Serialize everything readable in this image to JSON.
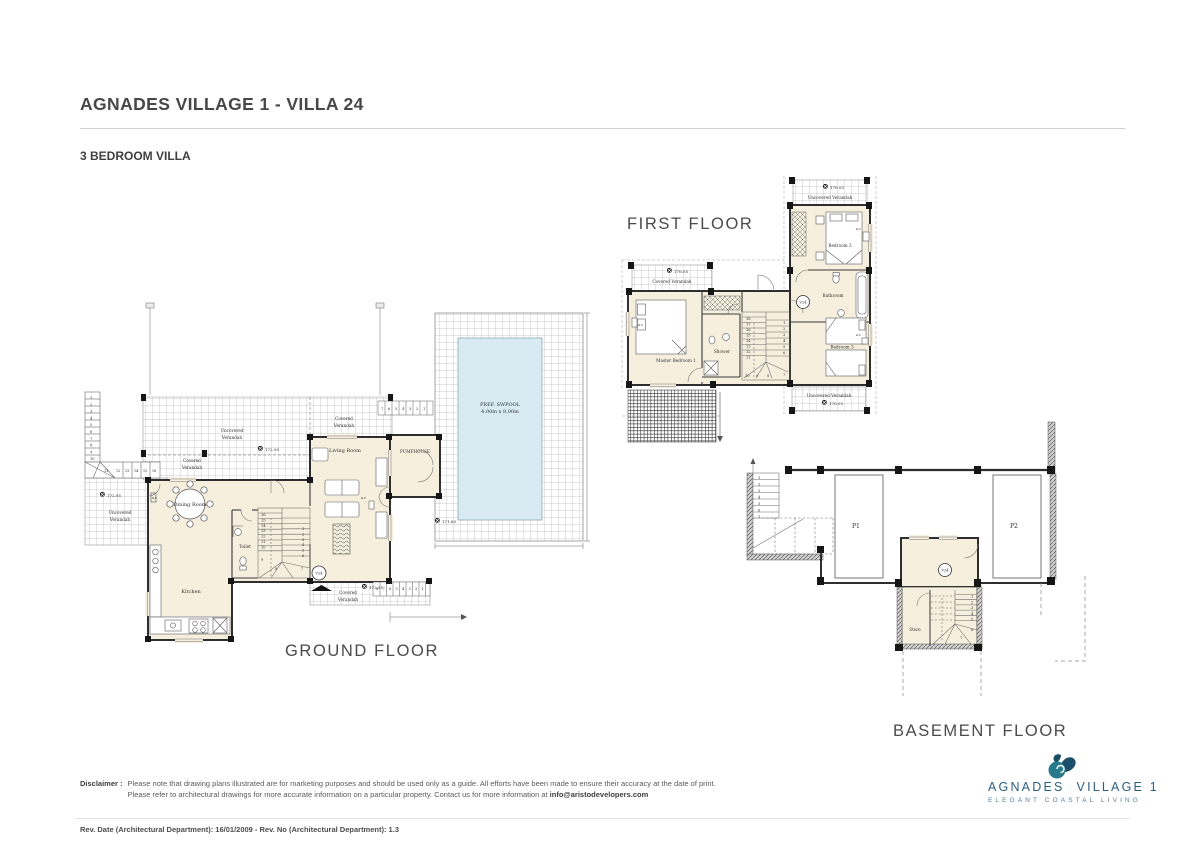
{
  "header": {
    "title": "AGNADES VILLAGE 1 - VILLA 24",
    "subtitle": "3 BEDROOM VILLA"
  },
  "labels": {
    "covered": "Covered Verandah",
    "uncovered": "Uncovered Verandah",
    "covered_1": "Covered",
    "covered_2": "Verandah",
    "uncovered_1": "Uncovered",
    "uncovered_2": "Verandah",
    "ac": "a.c",
    "unit": "V24"
  },
  "ground": {
    "label": "GROUND FLOOR",
    "dining": "Dining Room",
    "toilet": "Toilet",
    "kitchen": "Kitchen",
    "living": "Living Room",
    "pumphouse": "PUMPHOUSE",
    "pool_name": "PREF. SWPOOL",
    "pool_size": "4.00m x 8.00m",
    "level_pool": "171.60",
    "level_top": "172.95",
    "level_left": "172.95",
    "level_bottom": "172.95",
    "stair_ext_col": [
      "1",
      "2",
      "3",
      "4",
      "5",
      "6",
      "7",
      "8",
      "9",
      "10"
    ],
    "stair_ext_11": "11",
    "stair_ext_row": [
      "12",
      "13",
      "14",
      "15",
      "16"
    ],
    "steps_top": [
      "7",
      "6",
      "5",
      "4",
      "3",
      "2",
      "1"
    ],
    "steps_bottom": [
      "8",
      "7",
      "6",
      "5",
      "4",
      "3",
      "2",
      "1"
    ],
    "stair_in_left": [
      "16",
      "15",
      "14",
      "13",
      "12",
      "11",
      "10"
    ],
    "stair_in_9": "9",
    "stair_in_8": "8",
    "stair_in_7": "7",
    "stair_in_right": [
      "1",
      "2",
      "3",
      "4",
      "5",
      "6"
    ]
  },
  "first": {
    "label": "FIRST FLOOR",
    "master": "Master Bedroom 1",
    "shower": "Shower",
    "bedroom2": "Bedroom 2",
    "bedroom3": "Bedroom 3",
    "bathroom": "Bathroom",
    "level_covered": "176.05",
    "level_top": "176.05",
    "level_bottom": "176.05",
    "stair_left": [
      "18",
      "17",
      "16",
      "15",
      "14",
      "13",
      "12",
      "11"
    ],
    "stair_bottom": [
      "10",
      "9",
      "8"
    ],
    "stair_right": [
      "1",
      "2",
      "3",
      "4",
      "5",
      "6"
    ],
    "stair_7": "7"
  },
  "basement": {
    "label": "BASEMENT FLOOR",
    "store": "Store",
    "p1": "P1",
    "p2": "P2",
    "stair_ext": [
      "1",
      "2",
      "3",
      "4",
      "5",
      "6",
      "7"
    ],
    "stair_in": [
      "1",
      "2",
      "3",
      "4",
      "5"
    ],
    "stair_in_6": "6",
    "stair_in_7": "7"
  },
  "footer": {
    "disclaimer_label": "Disclaimer :",
    "line1": "Please note that drawing plans illustrated are for marketing purposes and should be used only as a guide. All efforts have been made to ensure their accuracy at the date of print.",
    "line2": "Please refer to architectural drawings for more accurate information on a particular property. Contact us for more information at ",
    "email": "info@aristodevelopers.com",
    "rev": "Rev. Date (Architectural Department): 16/01/2009 - Rev. No (Architectural Department): 1.3"
  },
  "logo": {
    "name1": "AGNADES",
    "name2": "VILLAGE 1",
    "tagline": "ELEGANT COASTAL LIVING"
  },
  "colors": {
    "pool": "#d8ebf2",
    "cream": "#f6efde",
    "logo_teal": "#27798b",
    "logo_navy": "#1b4e6b",
    "logo_text": "#2e5f80"
  }
}
